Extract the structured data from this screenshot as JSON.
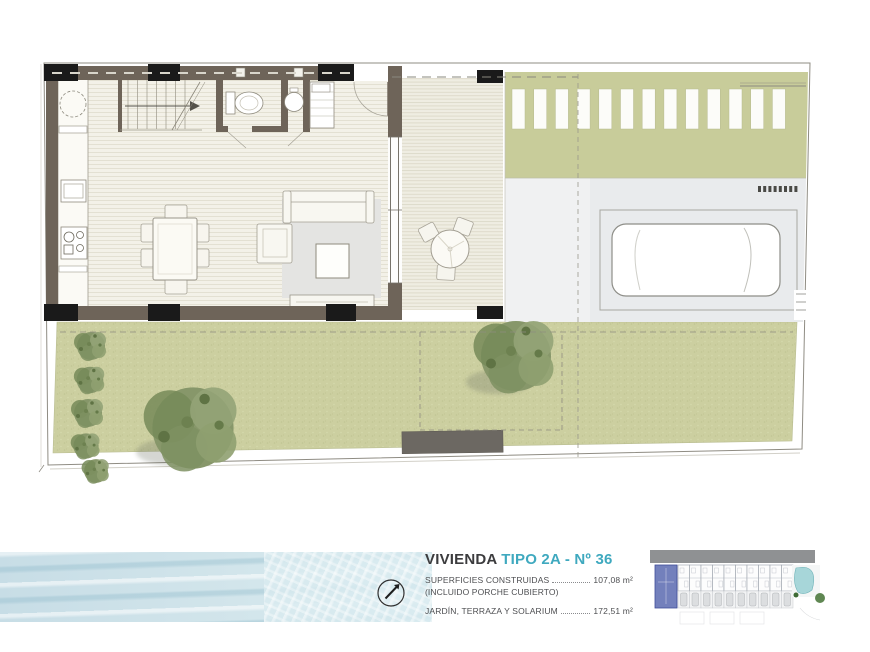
{
  "unit_info": {
    "name": "VIVIENDA",
    "type": "TIPO 2A - Nº 36",
    "accent_color": "#3fa9bf",
    "areas": [
      {
        "label": "SUPERFICIES CONSTRUIDAS",
        "value": "107,08 m²",
        "note": "(INCLUIDO PORCHE CUBIERTO)"
      },
      {
        "label": "JARDÍN, TERRAZA Y SOLARIUM",
        "value": "172,51 m²",
        "note": ""
      }
    ]
  },
  "icons": {
    "north_arrow": "compass-circle-with-needle-pointing-northeast"
  },
  "plan_colors": {
    "walls": "#6e6459",
    "columns": "#1a1a1a",
    "garden_green": "#cccfa0",
    "pergola_green": "#c8cc9a",
    "terrace_gray": "#e9ebed",
    "floor_cream": "#f3f1e8",
    "water_blue": "#d2e5eb",
    "site_highlight_blue": "#7380bc",
    "pool_teal": "#a7d6d9"
  }
}
